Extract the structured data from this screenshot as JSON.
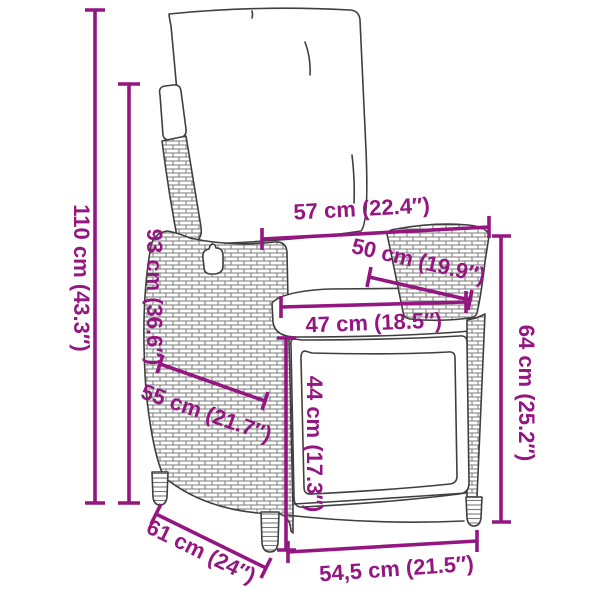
{
  "diagram": {
    "accent_color": "#941781",
    "outline_color": "#3f3f3f",
    "background_color": "#ffffff",
    "dimensions": {
      "overall_height": "110 cm (43.3″)",
      "backrest_height": "93 cm (36.6″)",
      "top_width": "57 cm (22.4″)",
      "armrest_depth": "50 cm (19.9″)",
      "seat_width": "47 cm (18.5″)",
      "armrest_height": "64 cm (25.2″)",
      "seat_height": "44 cm (17.3″)",
      "side_depth": "55 cm (21.7″)",
      "base_depth": "61 cm (24″)",
      "base_width": "54,5 cm (21.5″)"
    }
  }
}
